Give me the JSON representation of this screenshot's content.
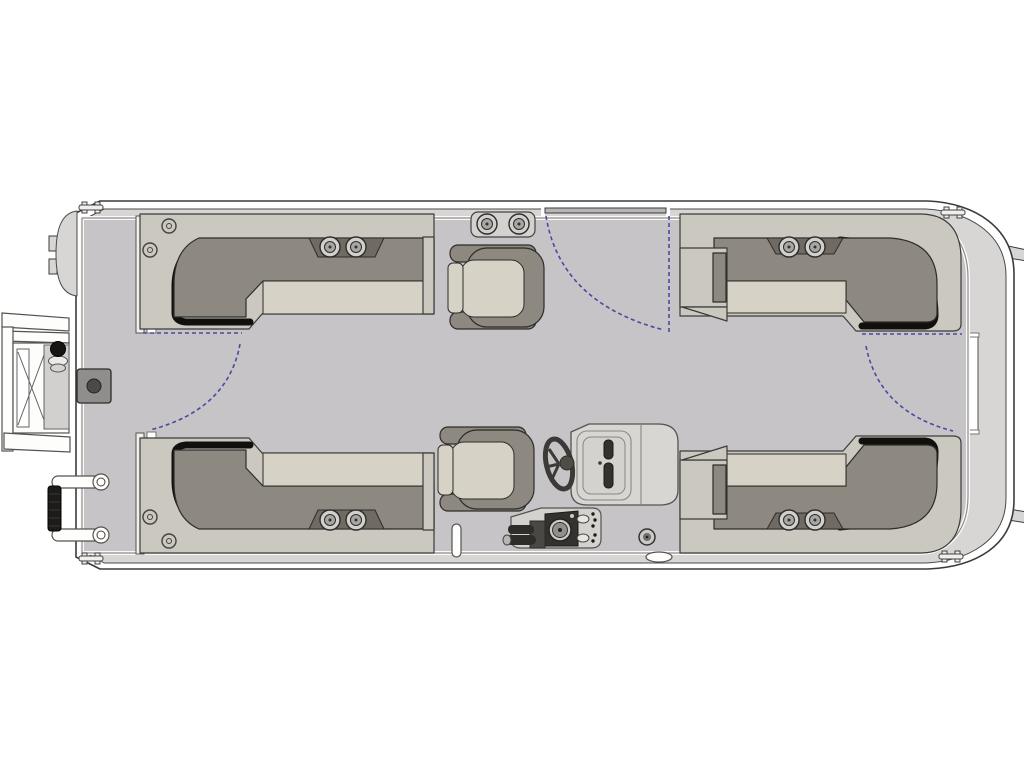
{
  "title": "Pontoon boat floor plan, overhead top view line drawing",
  "diagram_type": "boat-floorplan",
  "colors": {
    "white": "#ffffff",
    "outline": "#3b3b3b",
    "deck": "#c6c4c6",
    "fence": "#d8d6d4",
    "seat_base": "#cbc8bf",
    "seat_cushion": "#d6d2c6",
    "seat_back": "#8d8880",
    "shadow": "#12100d",
    "console": "#d8d6d2",
    "dark_panel": "#34312e",
    "gate_dash": "#4b49a0"
  },
  "components": {
    "hull": "pontoon hull with fence rail",
    "bow_ladder": "folding boarding ladder at bow",
    "bow_grab_rails": "bow grab handles with grip",
    "bow_hatch": "square deck hatch with latch",
    "nav_light": "bow navigation light fitting",
    "lounge_bow_port": "L-shaped lounge seat, bow port",
    "lounge_bow_starboard": "L-shaped lounge seat, bow starboard",
    "lounge_stern_port": "L-shaped lounge seat, stern port",
    "lounge_stern_starboard": "L-shaped lounge seat, stern starboard",
    "captain_chair_port": "swivel chair, port midship",
    "captain_chair_starboard": "helm swivel chair, starboard midship",
    "helm_console": "helm console with windscreen and dashboard",
    "steering_wheel": "steering wheel",
    "throttle": "throttle lever",
    "gates": [
      "bow gate swing",
      "port side gate swing",
      "stern gate swing"
    ],
    "cup_holders": "paired cup holders on seat backs",
    "cleats": "mooring cleats at four corners",
    "ski_pole": "deck pole near starboard chair",
    "transom_tabs": "transom brackets on stern edge"
  }
}
